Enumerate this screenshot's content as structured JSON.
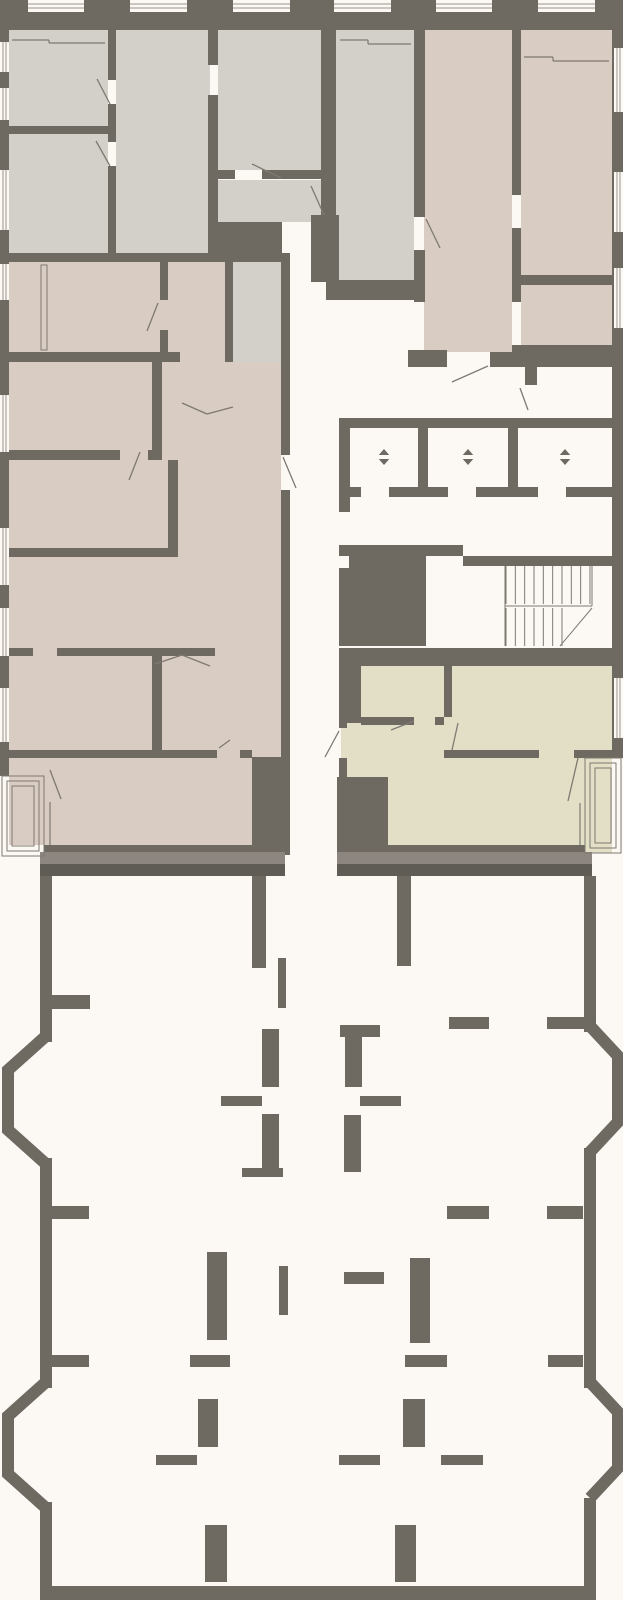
{
  "plan": {
    "type": "architectural-floor-plan",
    "canvas": {
      "w": 623,
      "h": 1600
    },
    "palette": {
      "bg": "#fcf8f4",
      "wall": "#6e6a62",
      "wallLight": "#8d8680",
      "wallDark": "#5f5b55",
      "grey": "#d3d0ca",
      "beige": "#d9ccc2",
      "khaki": "#e3dfc7",
      "white": "#fcf8f4",
      "line": "#7e7971",
      "windowLine": "#9a948c"
    },
    "rooms": [
      [
        9,
        10,
        99,
        116,
        "grey",
        "room-grey-top-left"
      ],
      [
        9,
        134,
        99,
        119,
        "grey",
        "room-grey-left-2"
      ],
      [
        116,
        10,
        94,
        243,
        "grey",
        "room-grey-middle"
      ],
      [
        218,
        10,
        103,
        160,
        "grey",
        "room-grey-right-top"
      ],
      [
        218,
        180,
        103,
        42,
        "grey",
        "room-grey-right-lower"
      ],
      [
        336,
        10,
        78,
        270,
        "grey",
        "room-grey-tall-center"
      ],
      [
        233,
        253,
        48,
        109,
        "grey",
        "corridor-grey"
      ],
      [
        9,
        262,
        216,
        583,
        "beige",
        "apartment-beige-left"
      ],
      [
        225,
        362,
        56,
        483,
        "beige",
        "apartment-beige-left-hall"
      ],
      [
        424,
        10,
        88,
        342,
        "beige",
        "room-beige-right-corridor"
      ],
      [
        521,
        10,
        91,
        265,
        "beige",
        "room-beige-right-top"
      ],
      [
        521,
        285,
        91,
        60,
        "beige",
        "room-beige-right-lower"
      ],
      [
        341,
        658,
        271,
        195,
        "khaki",
        "apartment-khaki"
      ]
    ],
    "walls": [
      [
        0,
        0,
        623,
        30
      ],
      [
        0,
        0,
        9,
        776
      ],
      [
        612,
        0,
        11,
        758
      ],
      [
        9,
        126,
        99,
        8
      ],
      [
        108,
        10,
        8,
        70
      ],
      [
        108,
        104,
        8,
        38
      ],
      [
        108,
        166,
        8,
        87
      ],
      [
        208,
        10,
        10,
        55
      ],
      [
        208,
        95,
        10,
        127
      ],
      [
        218,
        170,
        17,
        9
      ],
      [
        262,
        170,
        59,
        9
      ],
      [
        208,
        222,
        74,
        40
      ],
      [
        0,
        253,
        225,
        9
      ],
      [
        225,
        253,
        8,
        109
      ],
      [
        281,
        253,
        9,
        202
      ],
      [
        281,
        490,
        9,
        355
      ],
      [
        321,
        10,
        15,
        205
      ],
      [
        311,
        215,
        28,
        67
      ],
      [
        326,
        280,
        88,
        20
      ],
      [
        414,
        10,
        11,
        207
      ],
      [
        414,
        250,
        11,
        52
      ],
      [
        512,
        10,
        9,
        185
      ],
      [
        512,
        228,
        9,
        74
      ],
      [
        521,
        275,
        91,
        10
      ],
      [
        512,
        345,
        100,
        22
      ],
      [
        408,
        350,
        39,
        17
      ],
      [
        490,
        352,
        22,
        15
      ],
      [
        525,
        367,
        12,
        18
      ],
      [
        0,
        352,
        180,
        10
      ],
      [
        160,
        262,
        8,
        38
      ],
      [
        160,
        330,
        8,
        22
      ],
      [
        152,
        362,
        10,
        88
      ],
      [
        0,
        450,
        120,
        10
      ],
      [
        148,
        450,
        14,
        10
      ],
      [
        168,
        460,
        10,
        97
      ],
      [
        0,
        548,
        178,
        9
      ],
      [
        0,
        648,
        33,
        8
      ],
      [
        57,
        648,
        158,
        8
      ],
      [
        152,
        656,
        10,
        94
      ],
      [
        0,
        750,
        162,
        8
      ],
      [
        162,
        750,
        55,
        8
      ],
      [
        240,
        750,
        12,
        8
      ],
      [
        252,
        757,
        38,
        98
      ],
      [
        44,
        845,
        237,
        10
      ],
      [
        339,
        418,
        273,
        10
      ],
      [
        339,
        428,
        11,
        84
      ],
      [
        418,
        428,
        10,
        59
      ],
      [
        508,
        428,
        10,
        59
      ],
      [
        339,
        487,
        22,
        10
      ],
      [
        389,
        487,
        59,
        10
      ],
      [
        476,
        487,
        62,
        10
      ],
      [
        566,
        487,
        46,
        10
      ],
      [
        339,
        545,
        124,
        11
      ],
      [
        463,
        556,
        149,
        10
      ],
      [
        339,
        556,
        87,
        90
      ],
      [
        339,
        648,
        273,
        18
      ],
      [
        339,
        648,
        22,
        75
      ],
      [
        361,
        717,
        53,
        8
      ],
      [
        435,
        717,
        9,
        8
      ],
      [
        444,
        658,
        8,
        59
      ],
      [
        444,
        750,
        95,
        8
      ],
      [
        574,
        750,
        38,
        8
      ],
      [
        339,
        723,
        8,
        5
      ],
      [
        339,
        758,
        8,
        19
      ],
      [
        337,
        777,
        51,
        76
      ],
      [
        341,
        845,
        244,
        8
      ],
      [
        40,
        876,
        12,
        166
      ],
      [
        40,
        1158,
        12,
        230
      ],
      [
        40,
        1502,
        12,
        84
      ],
      [
        584,
        876,
        12,
        156
      ],
      [
        584,
        1148,
        12,
        240
      ],
      [
        584,
        1498,
        12,
        88
      ],
      [
        40,
        1586,
        556,
        14
      ],
      [
        252,
        876,
        14,
        92
      ],
      [
        397,
        876,
        14,
        90
      ],
      [
        278,
        958,
        8,
        50
      ],
      [
        52,
        995,
        38,
        14
      ],
      [
        449,
        1017,
        40,
        12
      ],
      [
        547,
        1017,
        37,
        12
      ],
      [
        262,
        1029,
        17,
        58
      ],
      [
        340,
        1025,
        40,
        12
      ],
      [
        345,
        1029,
        17,
        58
      ],
      [
        221,
        1096,
        41,
        10
      ],
      [
        360,
        1096,
        41,
        10
      ],
      [
        262,
        1114,
        17,
        57
      ],
      [
        242,
        1168,
        41,
        9
      ],
      [
        344,
        1115,
        17,
        57
      ],
      [
        52,
        1206,
        37,
        13
      ],
      [
        447,
        1206,
        42,
        13
      ],
      [
        547,
        1206,
        36,
        13
      ],
      [
        207,
        1252,
        20,
        88
      ],
      [
        279,
        1266,
        9,
        49
      ],
      [
        344,
        1272,
        40,
        12
      ],
      [
        410,
        1258,
        20,
        85
      ],
      [
        52,
        1355,
        37,
        12
      ],
      [
        190,
        1355,
        40,
        12
      ],
      [
        405,
        1355,
        42,
        12
      ],
      [
        548,
        1355,
        35,
        12
      ],
      [
        198,
        1399,
        20,
        48
      ],
      [
        403,
        1399,
        22,
        48
      ],
      [
        156,
        1455,
        41,
        10
      ],
      [
        339,
        1455,
        41,
        10
      ],
      [
        441,
        1455,
        42,
        10
      ],
      [
        205,
        1525,
        22,
        57
      ],
      [
        395,
        1525,
        21,
        57
      ]
    ],
    "bands": [
      [
        40,
        852,
        245,
        12,
        "wallLight"
      ],
      [
        337,
        852,
        255,
        12,
        "wallLight"
      ],
      [
        40,
        864,
        245,
        12,
        "wallDark"
      ],
      [
        337,
        864,
        255,
        12,
        "wallDark"
      ]
    ],
    "cutouts": [
      [
        339,
        556,
        10,
        12
      ]
    ],
    "bays": [
      [
        [
          46,
          1036
        ],
        [
          8,
          1070
        ],
        [
          8,
          1130
        ],
        [
          46,
          1164
        ]
      ],
      [
        [
          46,
          1382
        ],
        [
          8,
          1416
        ],
        [
          8,
          1474
        ],
        [
          46,
          1508
        ]
      ],
      [
        [
          590,
          1026
        ],
        [
          618,
          1056
        ],
        [
          618,
          1122
        ],
        [
          590,
          1152
        ]
      ],
      [
        [
          590,
          1382
        ],
        [
          618,
          1412
        ],
        [
          618,
          1468
        ],
        [
          590,
          1498
        ]
      ]
    ],
    "windows": [
      [
        28,
        0,
        56,
        12,
        "h"
      ],
      [
        130,
        0,
        57,
        12,
        "h"
      ],
      [
        233,
        0,
        57,
        12,
        "h"
      ],
      [
        334,
        0,
        57,
        12,
        "h"
      ],
      [
        436,
        0,
        56,
        12,
        "h"
      ],
      [
        538,
        0,
        57,
        12,
        "h"
      ],
      [
        0,
        42,
        9,
        30,
        "v"
      ],
      [
        0,
        88,
        9,
        32,
        "v"
      ],
      [
        0,
        170,
        9,
        60,
        "v"
      ],
      [
        0,
        264,
        9,
        36,
        "v"
      ],
      [
        0,
        395,
        9,
        57,
        "v"
      ],
      [
        0,
        528,
        9,
        57,
        "v"
      ],
      [
        0,
        608,
        9,
        48,
        "v"
      ],
      [
        0,
        688,
        9,
        54,
        "v"
      ],
      [
        614,
        48,
        9,
        64,
        "v"
      ],
      [
        614,
        172,
        9,
        60,
        "v"
      ],
      [
        614,
        268,
        9,
        60,
        "v"
      ],
      [
        614,
        678,
        9,
        60,
        "v"
      ]
    ],
    "balconies": [
      [
        2,
        776,
        42,
        80
      ],
      [
        7,
        781,
        32,
        70
      ],
      [
        12,
        786,
        22,
        60
      ],
      [
        585,
        758,
        36,
        95
      ],
      [
        590,
        763,
        26,
        85
      ],
      [
        595,
        768,
        16,
        75
      ]
    ],
    "closet": [
      41,
      265,
      6,
      85
    ],
    "swing_lines": [
      [
        97,
        79,
        110,
        104
      ],
      [
        96,
        141,
        110,
        166
      ],
      [
        252,
        164,
        281,
        178
      ],
      [
        311,
        186,
        324,
        215
      ],
      [
        426,
        219,
        440,
        248
      ],
      [
        182,
        403,
        207,
        414
      ],
      [
        207,
        414,
        233,
        407
      ],
      [
        283,
        457,
        296,
        488
      ],
      [
        488,
        366,
        452,
        382
      ],
      [
        520,
        388,
        528,
        410
      ],
      [
        339,
        731,
        325,
        757
      ],
      [
        414,
        721,
        391,
        730
      ],
      [
        458,
        723,
        452,
        750
      ],
      [
        578,
        758,
        568,
        801
      ],
      [
        158,
        303,
        147,
        331
      ],
      [
        140,
        452,
        129,
        480
      ],
      [
        155,
        664,
        182,
        655
      ],
      [
        182,
        655,
        210,
        666
      ],
      [
        50,
        770,
        61,
        799
      ],
      [
        219,
        748,
        230,
        740
      ]
    ],
    "partition_lines": [
      [
        12,
        40,
        49,
        40
      ],
      [
        49,
        40,
        49,
        43
      ],
      [
        49,
        43,
        105,
        43
      ],
      [
        340,
        40,
        368,
        40
      ],
      [
        368,
        40,
        368,
        44
      ],
      [
        368,
        44,
        411,
        44
      ],
      [
        524,
        57,
        553,
        57
      ],
      [
        553,
        57,
        553,
        61
      ],
      [
        553,
        61,
        609,
        61
      ],
      [
        50,
        802,
        50,
        845
      ],
      [
        580,
        803,
        580,
        845
      ]
    ],
    "stairs": {
      "flights": [
        {
          "x0": 506,
          "step": 9.33,
          "count": 10,
          "y1": 566,
          "y2": 604
        },
        {
          "x0": 506,
          "step": 9.33,
          "count": 7,
          "y1": 608,
          "y2": 646
        }
      ],
      "border_lines": [
        [
          505,
          566,
          505,
          646
        ],
        [
          505,
          606,
          592,
          606
        ],
        [
          592,
          566,
          592,
          606
        ]
      ],
      "diagonal": [
        560,
        646,
        592,
        608
      ]
    },
    "elevators": {
      "icon": "elevator-up-down-arrows",
      "size": 7,
      "positions": [
        [
          384,
          457
        ],
        [
          468,
          457
        ],
        [
          565,
          457
        ]
      ]
    }
  }
}
